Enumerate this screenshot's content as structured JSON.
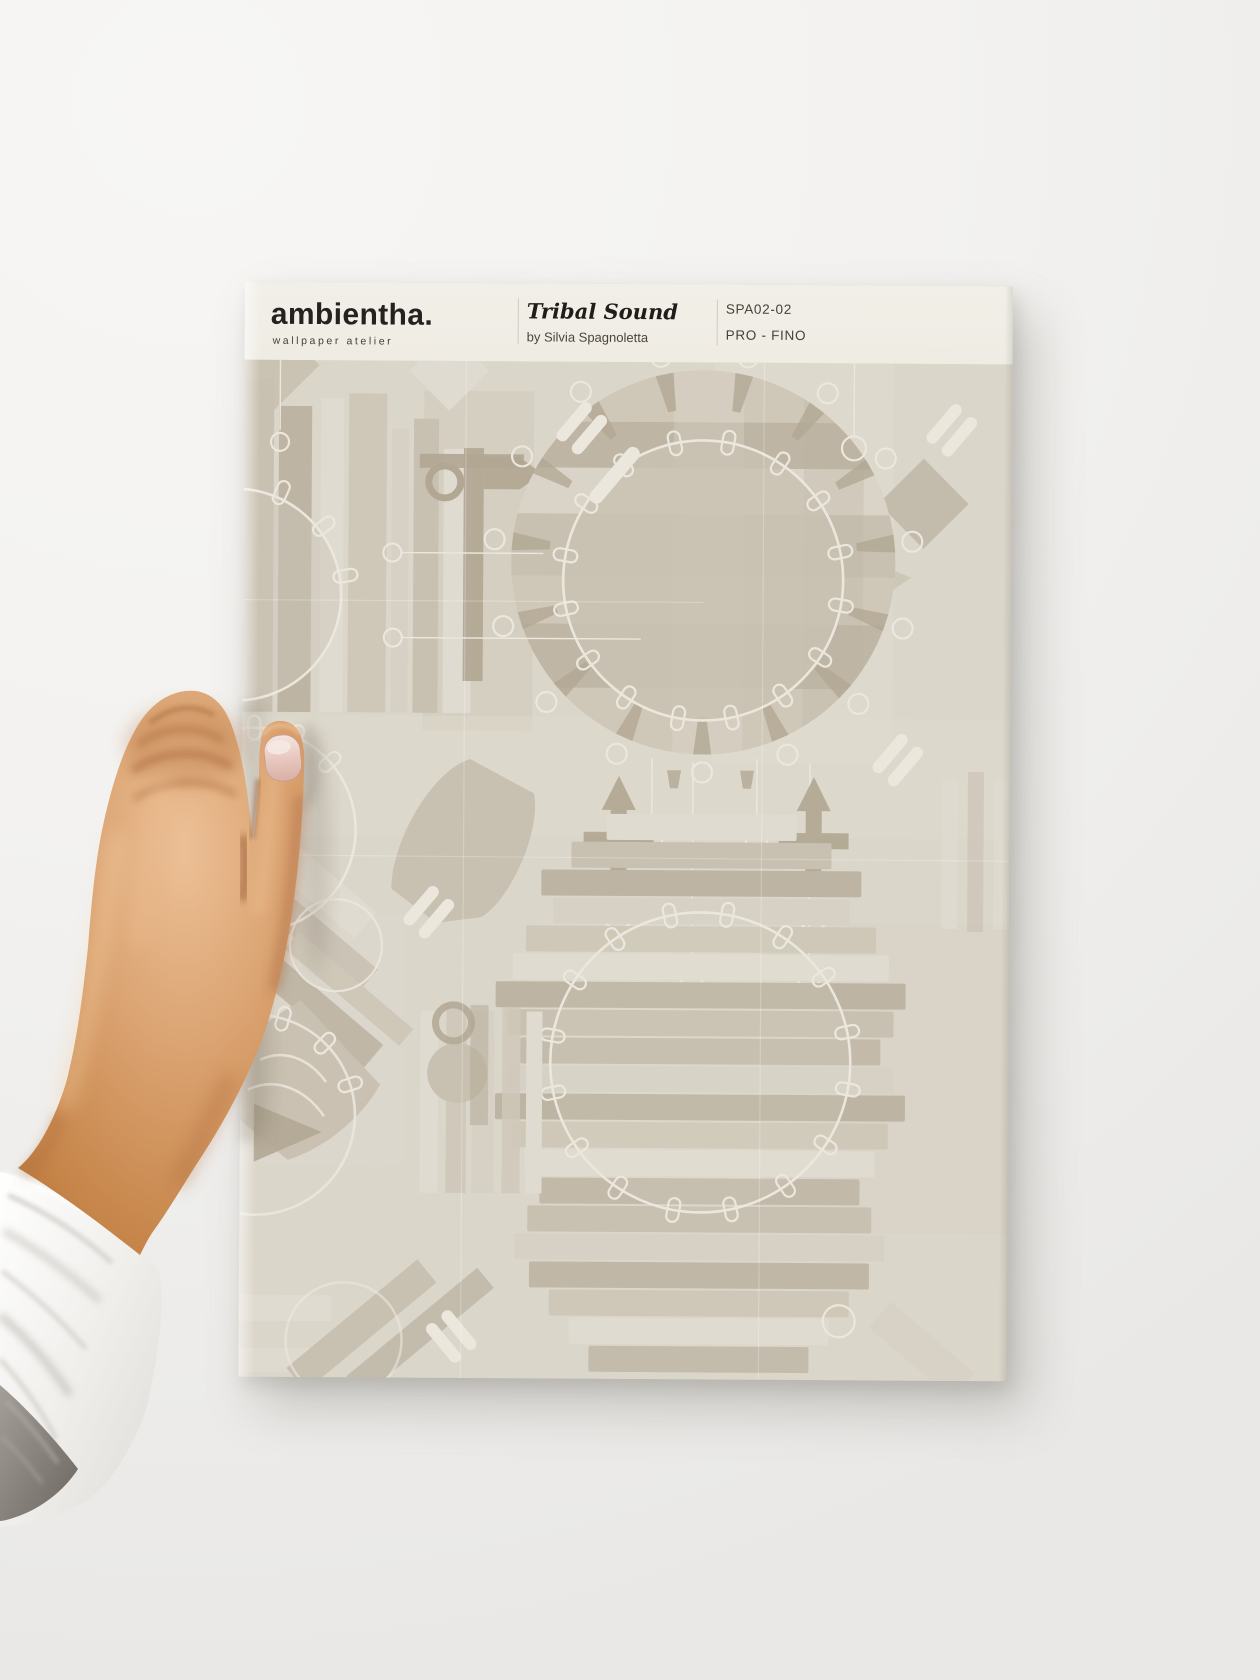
{
  "photo": {
    "subject": "hand holding a printed wallpaper sample sheet against a plain studio wall",
    "palette": {
      "bgTop": "#f7f6f4",
      "bgBottom": "#e9e8e6",
      "skinLight": "#ecc096",
      "skinMid": "#d89f6c",
      "skinBase": "#c68549",
      "skinShadow": "#a3643a",
      "skinDeep": "#7f4525",
      "nailBase": "#e6c6bd",
      "nailLight": "#f4e6e1",
      "cuffLight": "#fcfcfb",
      "cuffMid": "#efeeeb",
      "cuffFold": "#c9c5bf",
      "cuffDark": "#6b6660",
      "castShadow": "#6e6255"
    }
  },
  "sheet": {
    "header": {
      "brand": "ambientha.",
      "tagline": "wallpaper atelier",
      "title": "Tribal Sound",
      "author": "by Silvia Spagnoletta",
      "sku": "SPA02-02",
      "grade": "PRO - FINO"
    },
    "pattern": {
      "description": "abstract percussion motif: big drums with tuning lugs, xylophone bar stacks, mallets, shakers and horns layered in muted beige and greige tones",
      "palette": {
        "paperBase": "#dbd6ca",
        "headerBand": "#f2efe8",
        "barDark": "#bdb4a3",
        "barMid": "#c8c0b0",
        "barMid2": "#cfc8b9",
        "barLight": "#d7d1c5",
        "barLight2": "#e0dbd0",
        "drumFill": "#c6beaf",
        "accentDark": "#b1a793",
        "lineWhite": "#ebe7dd",
        "ink": "#242220",
        "inkSoft": "#45413b",
        "divider": "#cfcbc2"
      }
    }
  }
}
